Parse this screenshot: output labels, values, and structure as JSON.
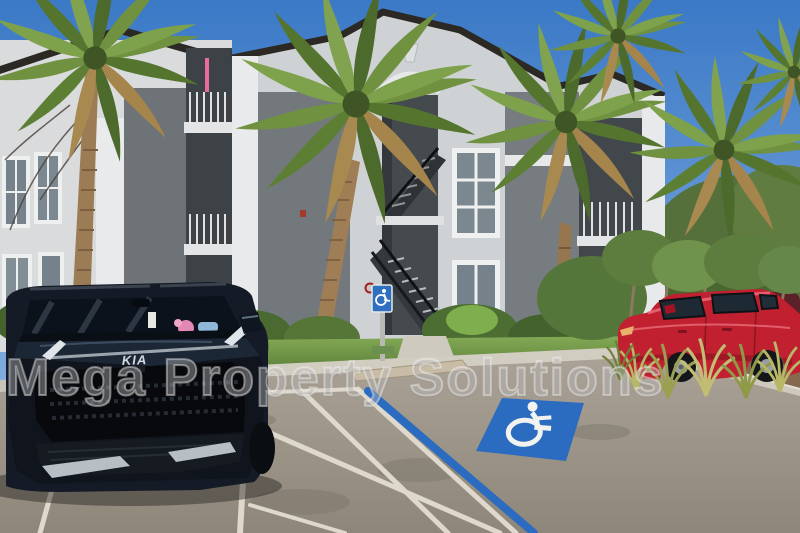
{
  "photo": {
    "watermark_text": "Mega Property Solutions",
    "suv_badge_text": "KIA"
  },
  "icons": {
    "pavement_symbol": "wheelchair-icon",
    "post_sign": "accessible-parking-sign"
  },
  "colors": {
    "sky_top": "#3b79c6",
    "sky_bottom": "#9cc0e8",
    "building_light_gray": "#d6d8d9",
    "building_dark_gray": "#6d7376",
    "roof_trim": "#2c2925",
    "palm_green": "#6f9140",
    "palm_dried": "#a5854c",
    "grass_green": "#7ba24f",
    "asphalt_gray": "#a79f94",
    "parking_line_white": "#ded9cc",
    "accessible_blue": "#2b6cc0",
    "sign_blue": "#2e6fc0",
    "suv_navy": "#141b27",
    "red_car": "#c0202f",
    "mulch_brown": "#87694f"
  }
}
